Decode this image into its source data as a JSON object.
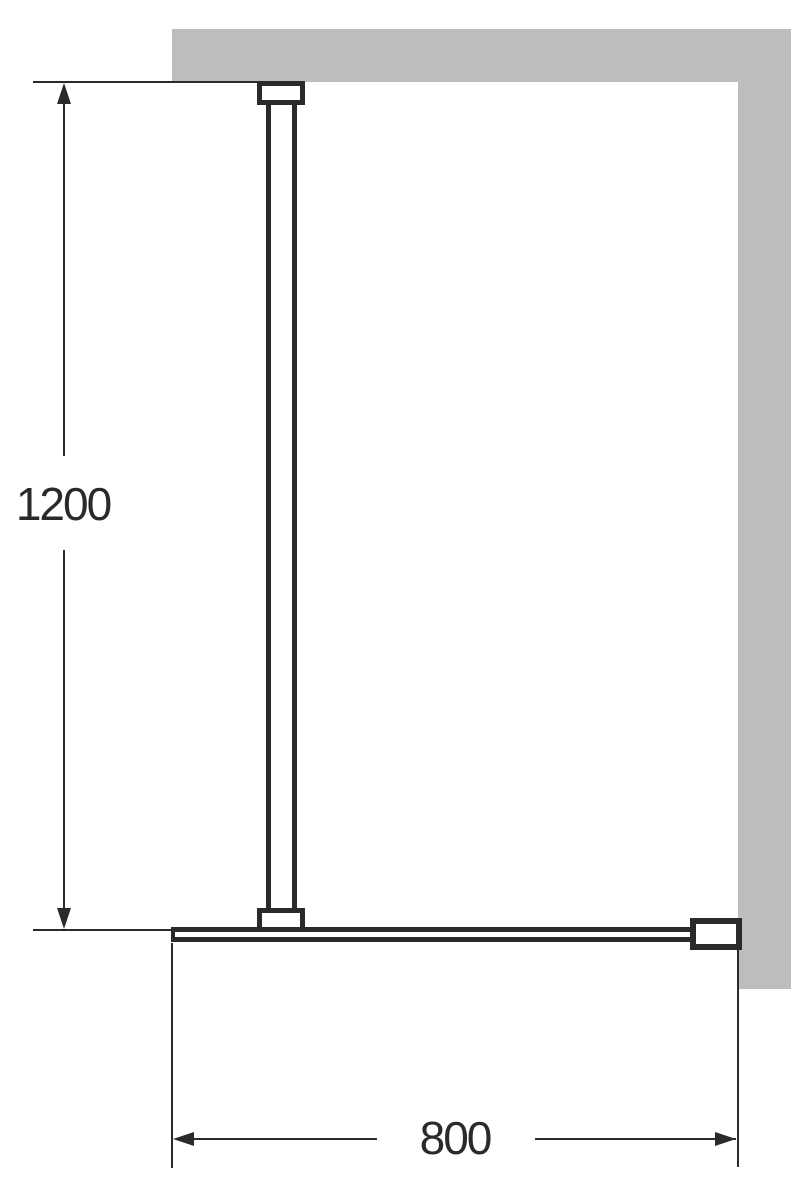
{
  "diagram": {
    "type": "technical-dimension-drawing",
    "subject": "walk-in shower glass panel with support bar and wall profile",
    "dimensions": {
      "height": {
        "label": "1200"
      },
      "width": {
        "label": "800"
      }
    },
    "colors": {
      "line": "#2b2a29",
      "wall": "#bbbdbf",
      "background": "#ffffff"
    }
  }
}
